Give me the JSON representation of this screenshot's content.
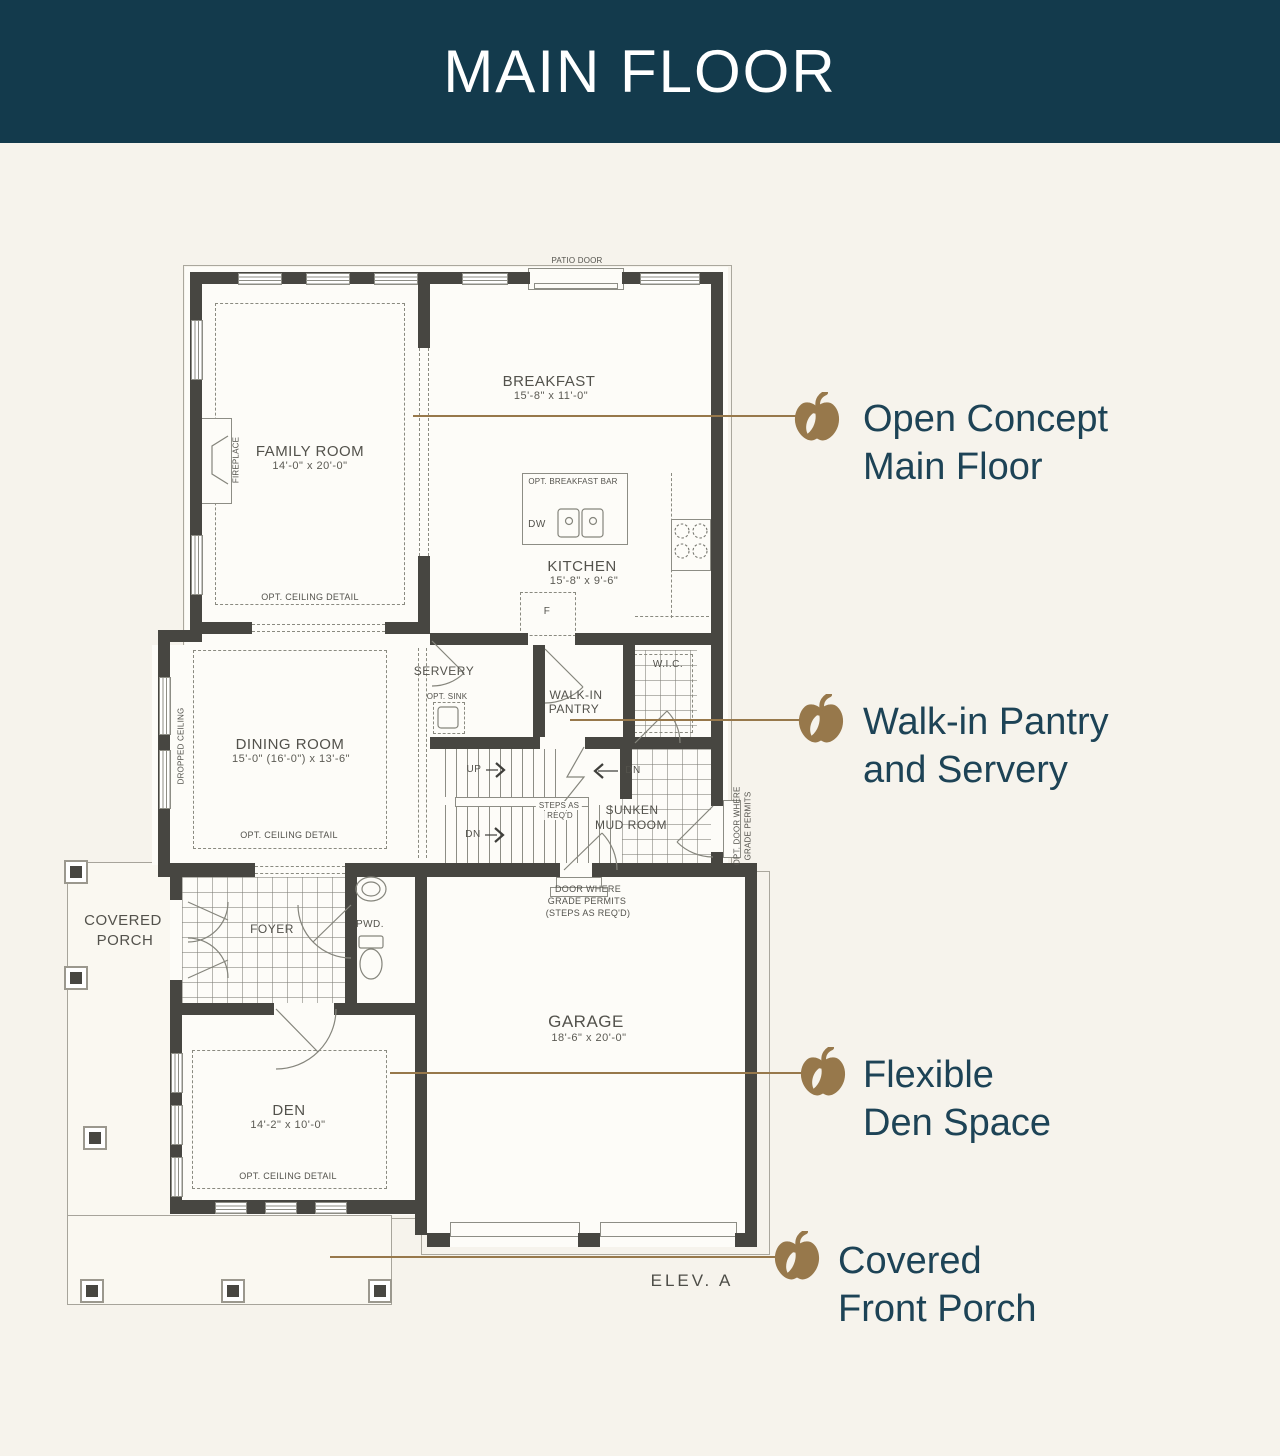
{
  "header": {
    "title": "MAIN FLOOR"
  },
  "colors": {
    "header_bg": "#133a4c",
    "page_bg": "#f6f3ec",
    "accent_gold": "#97784b",
    "callout_text": "#1d4356",
    "wall": "#474641"
  },
  "plan": {
    "family_room": {
      "name": "FAMILY ROOM",
      "dims": "14'-0\" x 20'-0\""
    },
    "breakfast": {
      "name": "BREAKFAST",
      "dims": "15'-8\" x 11'-0\""
    },
    "kitchen": {
      "name": "KITCHEN",
      "dims": "15'-8\" x 9'-6\""
    },
    "dining_room": {
      "name": "DINING ROOM",
      "dims": "15'-0\" (16'-0\") x 13'-6\""
    },
    "den": {
      "name": "DEN",
      "dims": "14'-2\" x 10'-0\""
    },
    "garage": {
      "name": "GARAGE",
      "dims": "18'-6\" x 20'-0\""
    },
    "servery": {
      "name": "SERVERY"
    },
    "pantry": {
      "line1": "WALK-IN",
      "line2": "PANTRY"
    },
    "wic": {
      "name": "W.I.C."
    },
    "mud_room": {
      "line1": "SUNKEN",
      "line2": "MUD ROOM"
    },
    "foyer": {
      "name": "FOYER"
    },
    "powder": {
      "name": "PWD."
    },
    "porch": {
      "line1": "COVERED",
      "line2": "PORCH"
    },
    "notes": {
      "opt_ceiling": "OPT. CEILING DETAIL",
      "patio_door": "PATIO DOOR",
      "fireplace": "FIREPLACE",
      "dropped_ceiling": "DROPPED CEILING",
      "opt_breakfast_bar": "OPT. BREAKFAST BAR",
      "dw": "DW",
      "fridge": "F",
      "opt_sink": "OPT. SINK",
      "up": "UP",
      "dn": "DN",
      "steps1": "STEPS AS",
      "steps2": "REQ'D",
      "side_door1": "OPT. DOOR WHERE",
      "side_door2": "GRADE PERMITS",
      "grade1": "DOOR WHERE",
      "grade2": "GRADE PERMITS",
      "grade3": "(STEPS AS REQ'D)",
      "elevation": "ELEV. A"
    }
  },
  "callouts": [
    {
      "line1": "Open Concept",
      "line2": "Main Floor"
    },
    {
      "line1": "Walk-in Pantry",
      "line2": "and Servery"
    },
    {
      "line1": "Flexible",
      "line2": "Den Space"
    },
    {
      "line1": "Covered",
      "line2": "Front Porch"
    }
  ]
}
